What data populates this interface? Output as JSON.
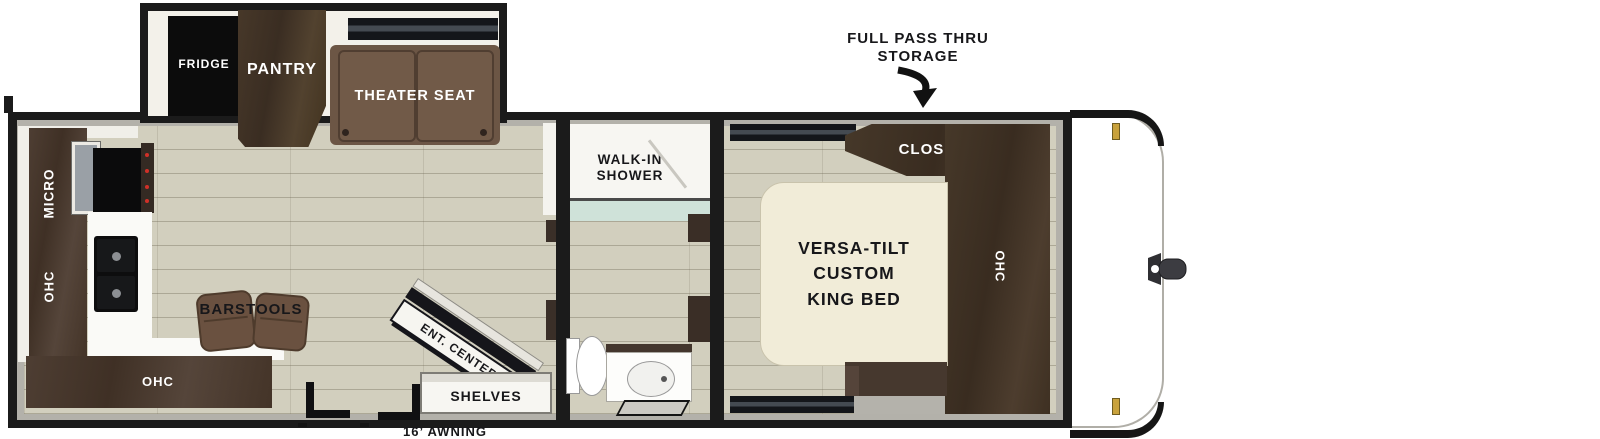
{
  "callouts": {
    "storage_line1": "FULL PASS THRU",
    "storage_line2": "STORAGE",
    "awning": "16’ AWNING"
  },
  "slideout": {
    "fridge": "FRIDGE",
    "pantry": "PANTRY",
    "theater_seat": "THEATER SEAT"
  },
  "kitchen": {
    "micro": "MICRO",
    "ohc_wall": "OHC",
    "ohc_base": "OHC",
    "barstools": "BARSTOOLS"
  },
  "living": {
    "ent_center": "ENT. CENTER",
    "shelves": "SHELVES"
  },
  "bathroom": {
    "shower_line1": "WALK-IN",
    "shower_line2": "SHOWER"
  },
  "bedroom": {
    "closet": "CLOSET",
    "bed_line1": "VERSA-TILT",
    "bed_line2": "CUSTOM",
    "bed_line3": "KING BED",
    "ohc": "OHC"
  },
  "colors": {
    "wall": "#1b1b1b",
    "rim_gray": "#b3b1aa",
    "floor": "#d2cfbe",
    "cabinet_brown": "#4a3a2f",
    "seat_brown": "#6c5645",
    "bed_cream": "#f1ecd8",
    "shower_glass": "#cfe2d9",
    "clearance_gold": "#c9a23c"
  }
}
